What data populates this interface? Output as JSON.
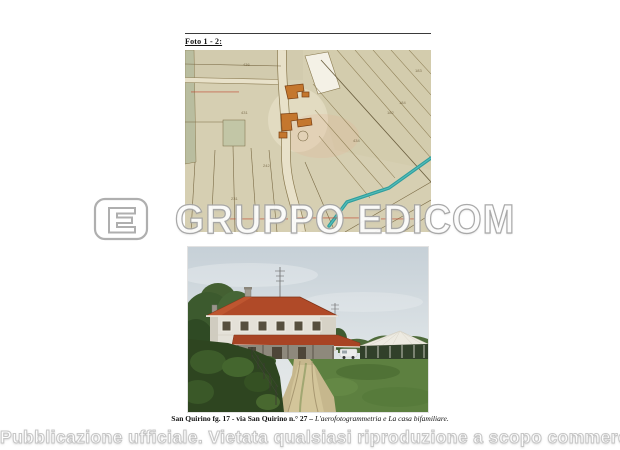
{
  "document": {
    "foto_label": "Foto 1 - 2:",
    "caption_bold": "San Quirino fg. 17 - via San Quirino n.° 27 – ",
    "caption_italic": "L'aerofotogrammetria e La casa bifamiliare."
  },
  "map": {
    "kind": "aerofotogrammetria-cadastral-map",
    "parcel_numbers": [
      "436",
      "431",
      "434",
      "184",
      "183",
      "182",
      "242",
      "231"
    ],
    "colors": {
      "parcel_beige": "#d6cfb2",
      "building_orange": "#c4772e",
      "stream_teal": "#2f9e9e",
      "boundary_brown": "#7a6a45"
    }
  },
  "photo": {
    "kind": "casa-bifamiliare-photo"
  },
  "watermark": {
    "logo": "edicom-e-logo",
    "text": "GRUPPO EDICOM"
  },
  "footer": {
    "notice": "Pubblicazione ufficiale. Vietata qualsiasi riproduzione a scopo commerciale"
  }
}
